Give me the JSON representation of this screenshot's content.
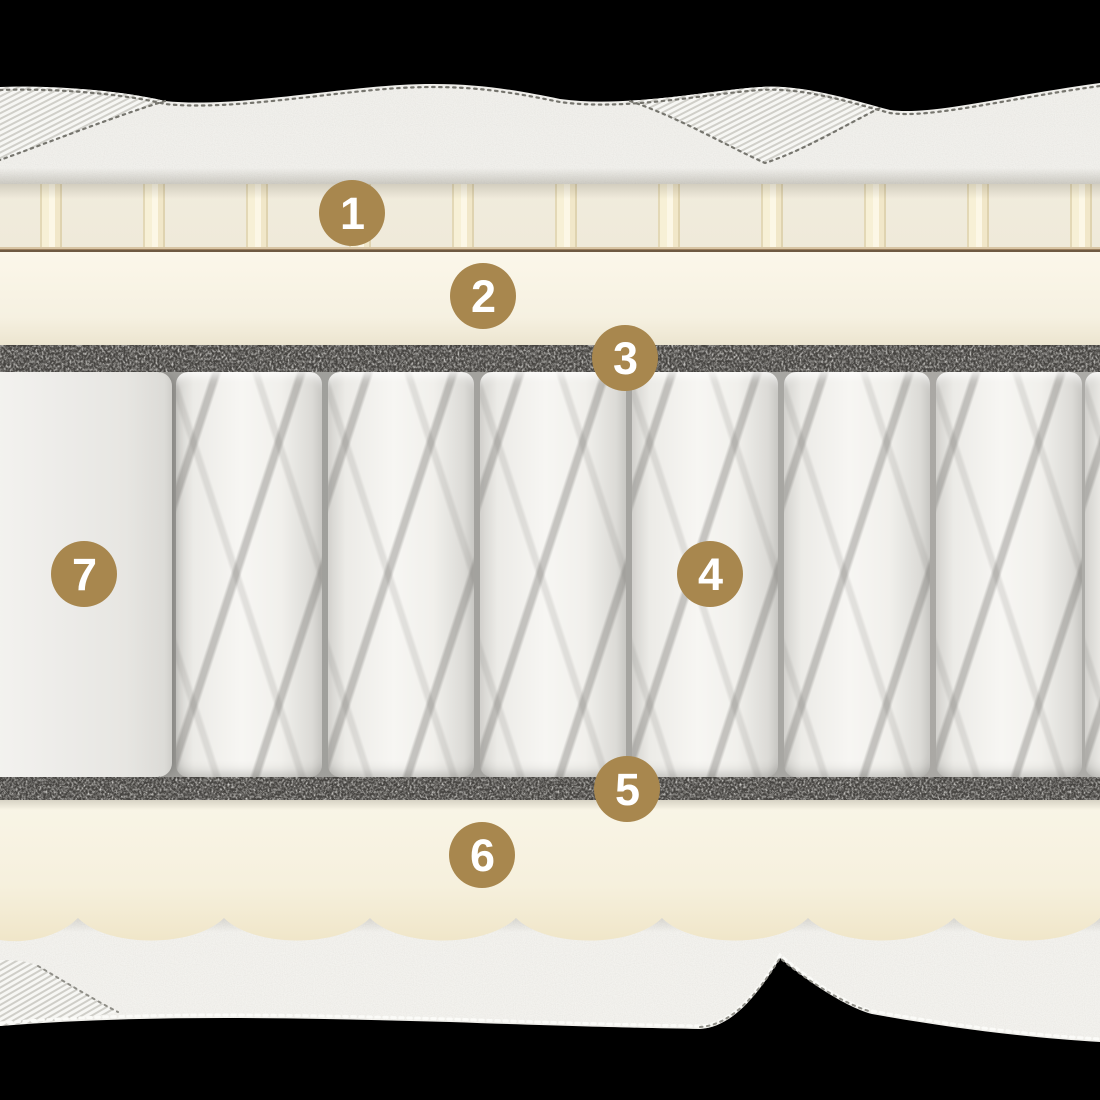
{
  "callouts": [
    {
      "number": "1"
    },
    {
      "number": "2"
    },
    {
      "number": "3"
    },
    {
      "number": "4"
    },
    {
      "number": "5"
    },
    {
      "number": "6"
    },
    {
      "number": "7"
    }
  ],
  "colors": {
    "accent": "#A8874E",
    "background": "#000000",
    "callout_text": "#FFFFFF",
    "cream_foam": "#F5F0DF",
    "slat_cream": "#F8F1D7",
    "felt_dark": "#454340",
    "fabric_white": "#F2F1ED",
    "glue_line_brown": "#8A7254"
  }
}
